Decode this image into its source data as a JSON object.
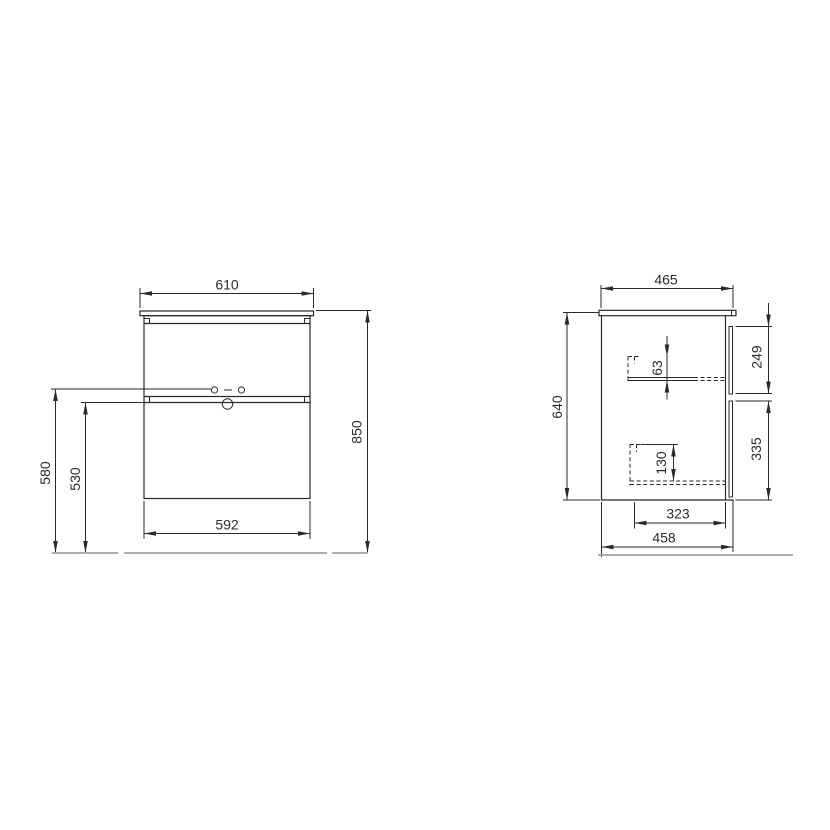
{
  "drawing": {
    "front_view": {
      "dimensions": {
        "countertop_width": "610",
        "overall_height": "850",
        "handle_holes_height": "580",
        "lower_drawer_top_height": "530",
        "cabinet_body_width": "592"
      }
    },
    "side_view": {
      "dimensions": {
        "countertop_depth": "465",
        "cabinet_body_height": "640",
        "upper_drawer_front_height": "249",
        "lower_drawer_front_height": "335",
        "upper_drawer_inner_height": "63",
        "lower_drawer_inner_height": "130",
        "drawer_box_depth": "323",
        "cabinet_body_depth": "458"
      }
    },
    "colors": {
      "line": "#2a282b",
      "ground_line": "#a3a3a3",
      "text": "#2b2b2b",
      "background": "#ffffff"
    }
  }
}
